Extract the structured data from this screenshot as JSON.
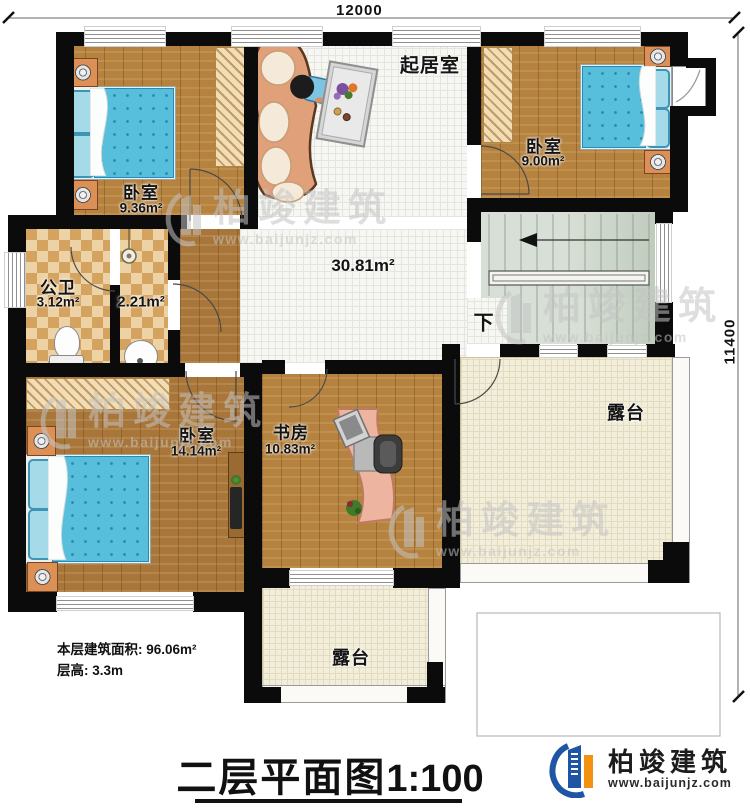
{
  "dimensions": {
    "top": "12000",
    "right": "11400"
  },
  "rooms": {
    "bedroom_tl": {
      "name": "卧室",
      "area": "9.36m²"
    },
    "bedroom_tr": {
      "name": "卧室",
      "area": "9.00m²"
    },
    "living": {
      "name": "起居室",
      "area": "30.81m²"
    },
    "bathroom": {
      "name": "公卫",
      "area": "3.12m²"
    },
    "washroom": {
      "area": "2.21m²"
    },
    "bedroom_bl": {
      "name": "卧室",
      "area": "14.14m²"
    },
    "study": {
      "name": "书房",
      "area": "10.83m²"
    },
    "terrace_right": {
      "name": "露台"
    },
    "terrace_bottom": {
      "name": "露台"
    }
  },
  "stairs": {
    "down_label": "下"
  },
  "annotations": {
    "floor_area": "本层建筑面积: 96.06m²",
    "floor_height": "层高: 3.3m"
  },
  "title": {
    "text": "二层平面图",
    "scale": "1:100"
  },
  "branding": {
    "company": "柏竣建筑",
    "website": "www.baijunjz.com"
  },
  "watermark": {
    "company": "柏竣建筑",
    "website": "www.baijunjz.com"
  },
  "colors": {
    "wall": "#0b0b0b",
    "wood": "#b5823f",
    "tile": "#f6f6f2",
    "terrace": "#f2eedb",
    "stairs": "#ccd6ca",
    "bed": "#57bedb",
    "checker_light": "#ecd2a4",
    "checker_dark": "#d5a360",
    "sofa": "#dfa07a",
    "desk": "#edb4a0",
    "logo_blue": "#1f55a5",
    "logo_orange": "#f39210"
  }
}
